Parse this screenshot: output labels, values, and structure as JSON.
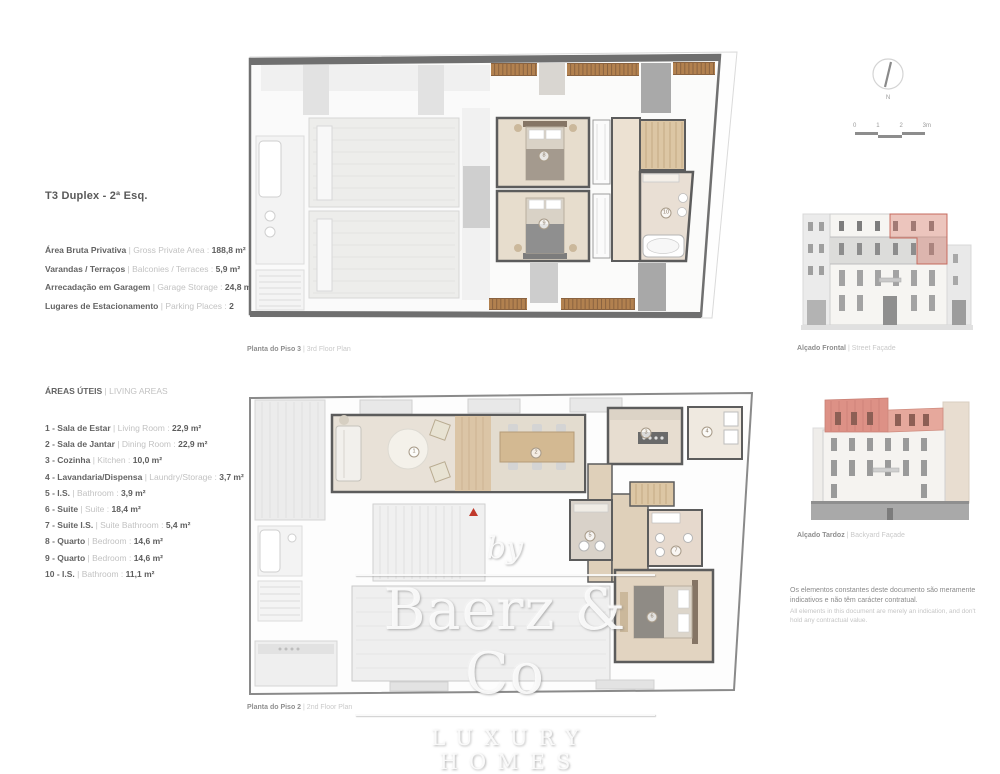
{
  "header": {
    "title": "T3 Duplex - 2ª Esq."
  },
  "summary": {
    "items": [
      {
        "pt": "Área Bruta Privativa",
        "en": "| Gross Private Area :",
        "value": "188,8 m²"
      },
      {
        "pt": "Varandas / Terraços",
        "en": "| Balconies / Terraces :",
        "value": "5,9 m²"
      },
      {
        "pt": "Arrecadação em Garagem",
        "en": "| Garage Storage :",
        "value": "24,8 m²"
      },
      {
        "pt": "Lugares de Estacionamento",
        "en": "| Parking Places :",
        "value": "2"
      }
    ]
  },
  "areas": {
    "title_pt": "ÁREAS ÚTEIS",
    "title_en": "| LIVING AREAS",
    "items": [
      {
        "pt": "1 - Sala de Estar",
        "en": "| Living Room :",
        "value": "22,9 m²"
      },
      {
        "pt": "2 - Sala de Jantar",
        "en": "| Dining Room :",
        "value": "22,9 m²"
      },
      {
        "pt": "3 - Cozinha",
        "en": "| Kitchen :",
        "value": "10,0 m²"
      },
      {
        "pt": "4 - Lavandaria/Dispensa",
        "en": "| Laundry/Storage :",
        "value": "3,7 m²"
      },
      {
        "pt": "5 - I.S.",
        "en": "| Bathroom :",
        "value": "3,9 m²"
      },
      {
        "pt": "6 - Suite",
        "en": "| Suite :",
        "value": "18,4 m²"
      },
      {
        "pt": "7 - Suite I.S.",
        "en": "| Suite Bathroom :",
        "value": "5,4 m²"
      },
      {
        "pt": "8 - Quarto",
        "en": "| Bedroom :",
        "value": "14,6 m²"
      },
      {
        "pt": "9 - Quarto",
        "en": "| Bedroom :",
        "value": "14,6 m²"
      },
      {
        "pt": "10 - I.S.",
        "en": "| Bathroom :",
        "value": "11,1 m²"
      }
    ]
  },
  "plans": {
    "upper_caption_pt": "Planta do Piso 3",
    "upper_caption_en": "| 3rd Floor Plan",
    "lower_caption_pt": "Planta do Piso 2",
    "lower_caption_en": "| 2nd Floor Plan",
    "upper_room_markers": [
      {
        "label": "8",
        "x": 544,
        "y": 156
      },
      {
        "label": "9",
        "x": 544,
        "y": 224
      },
      {
        "label": "10",
        "x": 666,
        "y": 213
      }
    ],
    "lower_room_markers": [
      {
        "label": "1",
        "x": 414,
        "y": 452
      },
      {
        "label": "2",
        "x": 536,
        "y": 453
      },
      {
        "label": "3",
        "x": 646,
        "y": 433
      },
      {
        "label": "4",
        "x": 707,
        "y": 432
      },
      {
        "label": "5",
        "x": 590,
        "y": 536
      },
      {
        "label": "6",
        "x": 652,
        "y": 617
      },
      {
        "label": "7",
        "x": 676,
        "y": 551
      }
    ]
  },
  "facades": {
    "front_pt": "Alçado Frontal",
    "front_en": "| Street Façade",
    "back_pt": "Alçado Tardoz",
    "back_en": "| Backyard Façade"
  },
  "compass": {
    "label": "N"
  },
  "scalebar": {
    "labels": [
      "0",
      "1",
      "2",
      "3m"
    ]
  },
  "disclaimer": {
    "pt": "Os elementos constantes deste documento são meramente indicativos e não têm carácter contratual.",
    "en": "All elements in this document are merely an indication, and don't hold any contractual value."
  },
  "watermark": {
    "by": "by",
    "name": "Baerz & Co",
    "tagline": "LUXURY HOMES"
  },
  "colors": {
    "wall_dark": "#5c5c5c",
    "floor_beige": "#e7ddcd",
    "wood_deck": "#b2814f",
    "highlight_pink": "#e2988f",
    "roof_red": "#dd9186",
    "entrance_red": "#c0392b"
  }
}
